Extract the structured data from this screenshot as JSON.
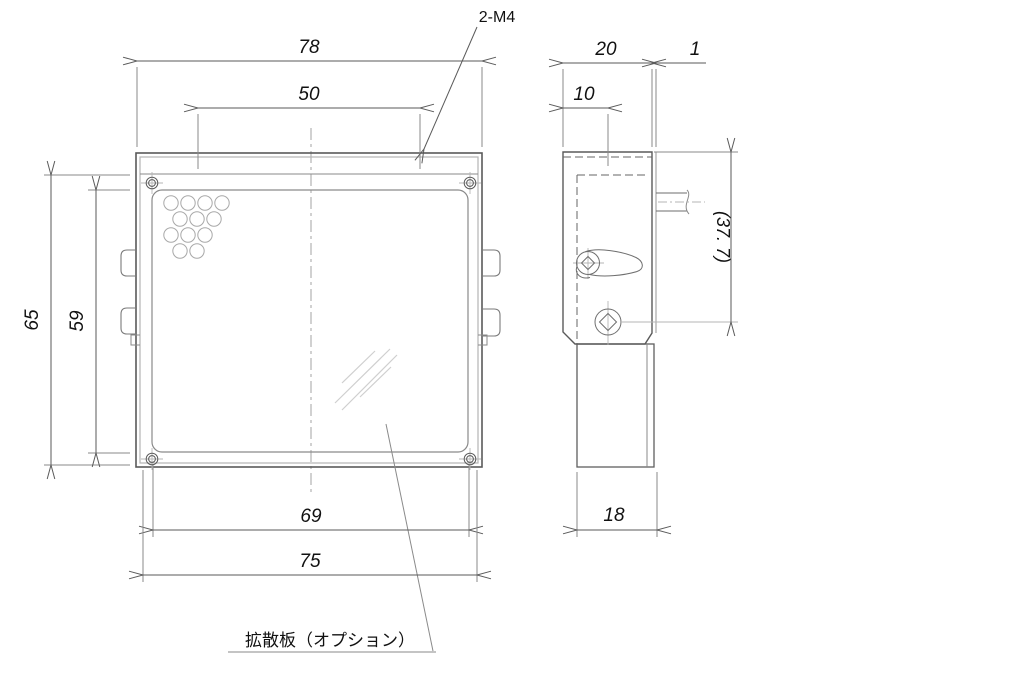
{
  "drawing": {
    "type": "engineering-drawing",
    "views": [
      "front",
      "side"
    ],
    "colors": {
      "background": "#ffffff",
      "outline": "#5a5a5a",
      "thin_line": "#8a8a8a",
      "accent_gray": "#b5b5b5",
      "hidden_line": "#666666",
      "reflection": "#cfcfcf",
      "text": "#111111"
    },
    "front_view": {
      "dim_overall_width": "78",
      "dim_hole_spacing": "50",
      "dim_overall_height": "65",
      "dim_window_height": "59",
      "dim_screw_span": "69",
      "dim_body_width": "75",
      "thread_note": "2-M4",
      "diffuser_note": "拡散板（オプション）",
      "vent_hole_rows": [
        4,
        3,
        3,
        2
      ],
      "corner_screws": 4,
      "side_tabs": 4
    },
    "side_view": {
      "dim_overall_depth": "20",
      "dim_plate_thickness": "1",
      "dim_hole_offset": "10",
      "dim_height_reference": "(37. 7)",
      "dim_body_depth": "18"
    }
  }
}
